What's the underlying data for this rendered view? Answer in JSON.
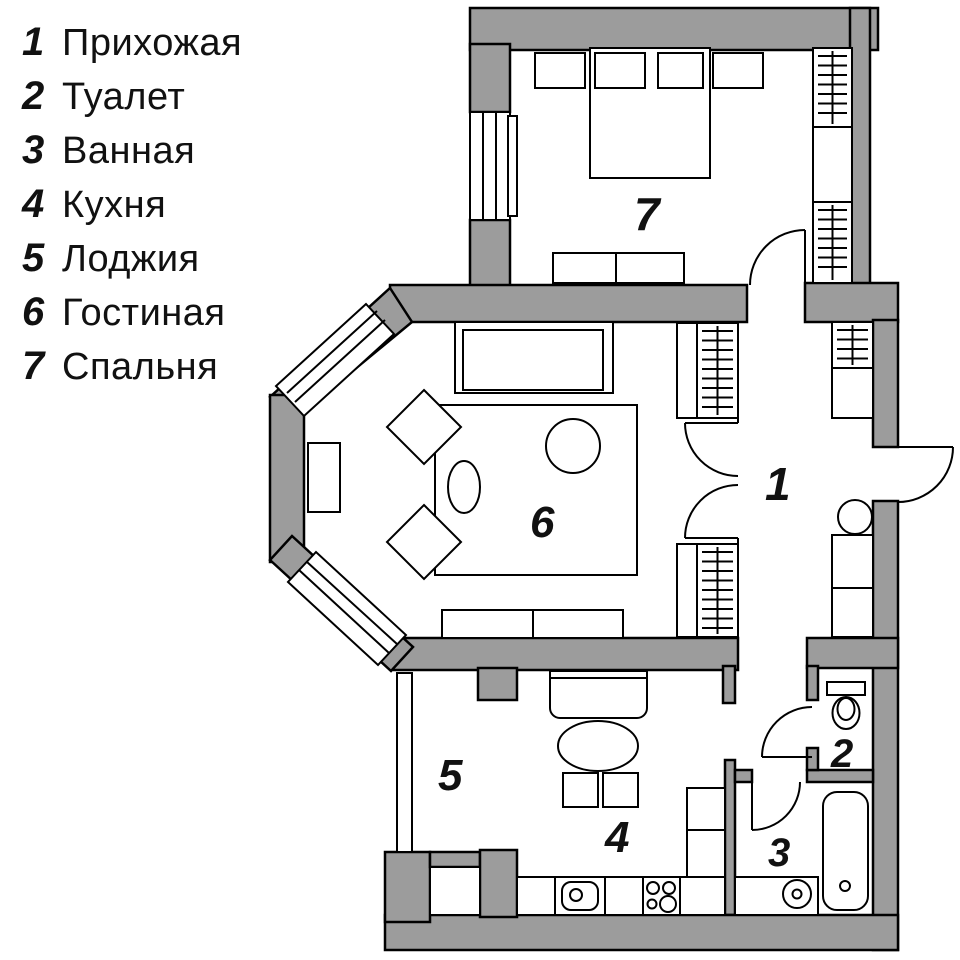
{
  "title": "Apartment floor plan",
  "rooms": [
    {
      "number": "1",
      "label": "Прихожая"
    },
    {
      "number": "2",
      "label": "Туалет"
    },
    {
      "number": "3",
      "label": "Ванная"
    },
    {
      "number": "4",
      "label": "Кухня"
    },
    {
      "number": "5",
      "label": "Лоджия"
    },
    {
      "number": "6",
      "label": "Гостиная"
    },
    {
      "number": "7",
      "label": "Спальня"
    }
  ],
  "colors": {
    "wall_fill": "#9C9C9C",
    "outline": "#000000",
    "background": "#FFFFFF",
    "text": "#111111"
  }
}
